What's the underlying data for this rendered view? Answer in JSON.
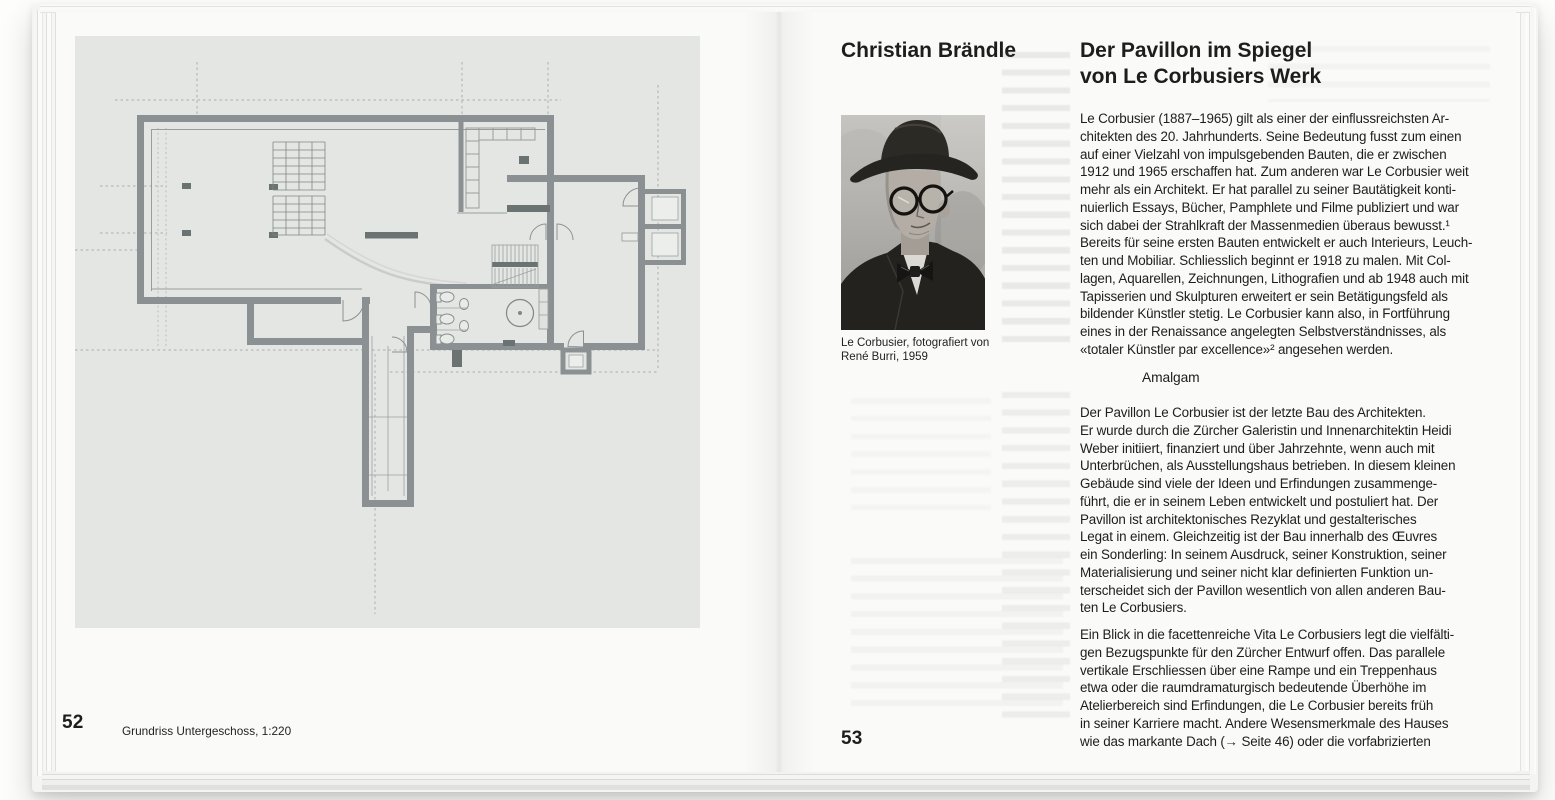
{
  "colors": {
    "paper": "#fafaf9",
    "plan_panel": "#e4e6e3",
    "wall_gray": "#8b9192",
    "text": "#1d1d1b"
  },
  "left_page": {
    "page_number": "52",
    "plan_caption": "Grundriss Untergeschoss, 1:220"
  },
  "right_page": {
    "page_number": "53",
    "author": "Christian Brändle",
    "title_lines": [
      "Der Pavillon im Spiegel",
      "von Le Corbusiers Werk"
    ],
    "photo_caption_lines": [
      "Le Corbusier, fotografiert von",
      "René Burri, 1959"
    ],
    "paragraph1_lines": [
      "Le Corbusier (1887–1965) gilt als einer der einflussreichsten Ar-",
      "chitekten des 20. Jahrhunderts. Seine Bedeutung fusst zum einen",
      "auf einer Vielzahl von impulsgebenden Bauten, die er zwischen",
      "1912 und 1965 erschaffen hat. Zum anderen war Le Corbusier weit",
      "mehr als ein Architekt. Er hat parallel zu seiner Bautätigkeit konti-",
      "nuierlich Essays, Bücher, Pamphlete und Filme publiziert und war",
      "sich dabei der Strahlkraft der Massenmedien überaus bewusst.¹",
      "Bereits für seine ersten Bauten entwickelt er auch Interieurs, Leuch-",
      "ten und Mobiliar. Schliesslich beginnt er 1918 zu malen. Mit Col-",
      "lagen, Aquarellen, Zeichnungen, Lithografien und ab 1948 auch mit",
      "Tapisserien und Skulpturen erweitert er sein Betätigungsfeld als",
      "bildender Künstler stetig. Le Corbusier kann also, in Fortführung",
      "eines in der Renaissance angelegten Selbstverständnisses, als",
      "«totaler Künstler par excellence»² angesehen werden."
    ],
    "subheading": "Amalgam",
    "paragraph2_lines": [
      "Der Pavillon Le Corbusier ist der letzte Bau des Architekten.",
      "Er wurde durch die Zürcher Galeristin und Innenarchitektin Heidi",
      "Weber initiiert, finanziert und über Jahrzehnte, wenn auch mit",
      "Unterbrüchen, als Ausstellungshaus betrieben. In diesem kleinen",
      "Gebäude sind viele der Ideen und Erfindungen zusammenge-",
      "führt, die er in seinem Leben entwickelt und postuliert hat. Der",
      "Pavillon ist architektonisches Rezyklat und gestalterisches",
      "Legat in einem. Gleichzeitig ist der Bau innerhalb des Œuvres",
      "ein Sonderling: In seinem Ausdruck, seiner Konstruktion, seiner",
      "Materialisierung und seiner nicht klar definierten Funktion un-",
      "terscheidet sich der Pavillon wesentlich von allen anderen Bau-",
      "ten Le Corbusiers."
    ],
    "paragraph3_lines": [
      "Ein Blick in die facettenreiche Vita Le Corbusiers legt die vielfälti-",
      "gen Bezugspunkte für den Zürcher Entwurf offen. Das parallele",
      "vertikale Erschliessen über eine Rampe und ein Treppenhaus",
      "etwa oder die raumdramaturgisch bedeutende Überhöhe im",
      "Atelierbereich sind Erfindungen, die Le Corbusier bereits früh",
      "in seiner Karriere macht. Andere Wesensmerkmale des Hauses",
      "wie das markante Dach (→ Seite 46) oder die vorfabrizierten"
    ]
  }
}
